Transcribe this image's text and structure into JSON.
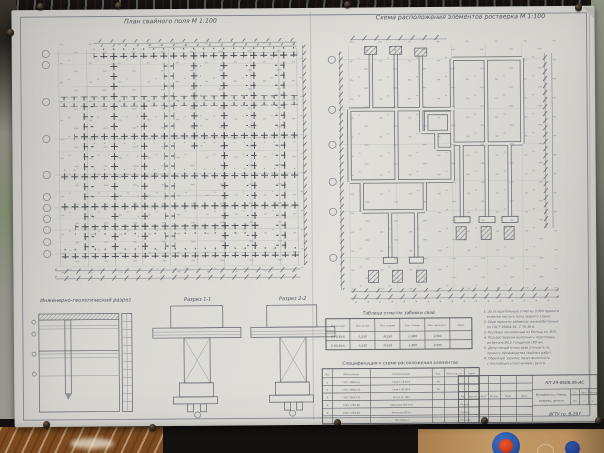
{
  "titles": {
    "left_plan": "План свайного поля  М 1:100",
    "right_plan": "Схема расположения элементов ростверка  М 1:100",
    "geo_section": "Инженерно-геологический разрез",
    "section_11": "Разрез 1-1",
    "section_22": "Разрез 2-2"
  },
  "pile_table": {
    "title": "Таблица отметок забивки свай",
    "headers": [
      "Марка сваи",
      "Отм. устья",
      "Отм. острия",
      "Отм. головы",
      "Отм. низа рост.",
      "Прим."
    ],
    "rows": [
      [
        "С 70.30-6",
        "-1,550",
        "-8,550",
        "-1,900",
        "-2,050",
        ""
      ],
      [
        "С 80.30-6",
        "-1,550",
        "-9,550",
        "-1,900",
        "-2,050",
        ""
      ]
    ]
  },
  "spec_table": {
    "title": "Спецификация к схеме расположения элементов",
    "headers": [
      "Поз.",
      "Обозначение",
      "Наименование",
      "Кол.",
      "Масса ед., кг",
      "Прим."
    ],
    "rows": [
      [
        "1",
        "ГОСТ 19804-91",
        "Свая С 70.30-6",
        "64",
        "",
        ""
      ],
      [
        "2",
        "ГОСТ 19804-91",
        "Свая С 80.30-6",
        "26",
        "",
        ""
      ],
      [
        "3",
        "ГОСТ 26633-91",
        "Бетон кл. В15",
        "",
        "",
        ""
      ],
      [
        "4",
        "ГОСТ 5781-82",
        "Арматура Ø12 А-III",
        "",
        "",
        ""
      ],
      [
        "5",
        "ГОСТ 5781-82",
        "Арматура Ø6 А-I",
        "",
        "",
        ""
      ],
      [
        "",
        "",
        "Материалы",
        "",
        "",
        ""
      ]
    ]
  },
  "notes": {
    "lines": [
      "1. За относительную отметку 0,000 принята",
      "отметка чистого пола первого этажа.",
      "2. Сваи приняты забивные железобетонные",
      "по ГОСТ 19804-91, С 70.30-6.",
      "3. Ростверк монолитный из бетона кл. В15.",
      "4. Под ростверком выполнить подготовку",
      "из бетона В3,5 толщиной 100 мм.",
      "5. Допустимый отказ сваи уточнить по",
      "проекту производства свайных работ.",
      "6. Обратную засыпку пазух выполнить",
      "с послойным уплотнением грунта."
    ]
  },
  "stamp": {
    "code": "КП 29-0608.06-АС",
    "subject_line1": "Фундаменты. Планы,",
    "subject_line2": "разрезы, детали",
    "stage_label": "Ст.",
    "sheet_label": "Лист",
    "sheets_label": "Листов",
    "stage": "КП",
    "sheet_no": "1",
    "sheets_no": "1",
    "org": "ВГТУ  гр. В-297",
    "header_cells": [
      "Изм.",
      "Кол.уч.",
      "Лист",
      "№ док.",
      "Подп.",
      "Дата"
    ],
    "roles": [
      "Разраб.",
      "Провер.",
      "Н.контр."
    ]
  },
  "colors": {
    "paper": "#dbdad5",
    "ink": "#4e525a",
    "wood_top": "#c7a089",
    "wood_bottom_left": "#7c4a1e",
    "wood_bottom_right": "#b88c55",
    "board_dark": "#141110",
    "magnet_blue": "#2b57a8",
    "magnet_red": "#d23c16",
    "magnet_small_blue": "#1d3f8e"
  }
}
